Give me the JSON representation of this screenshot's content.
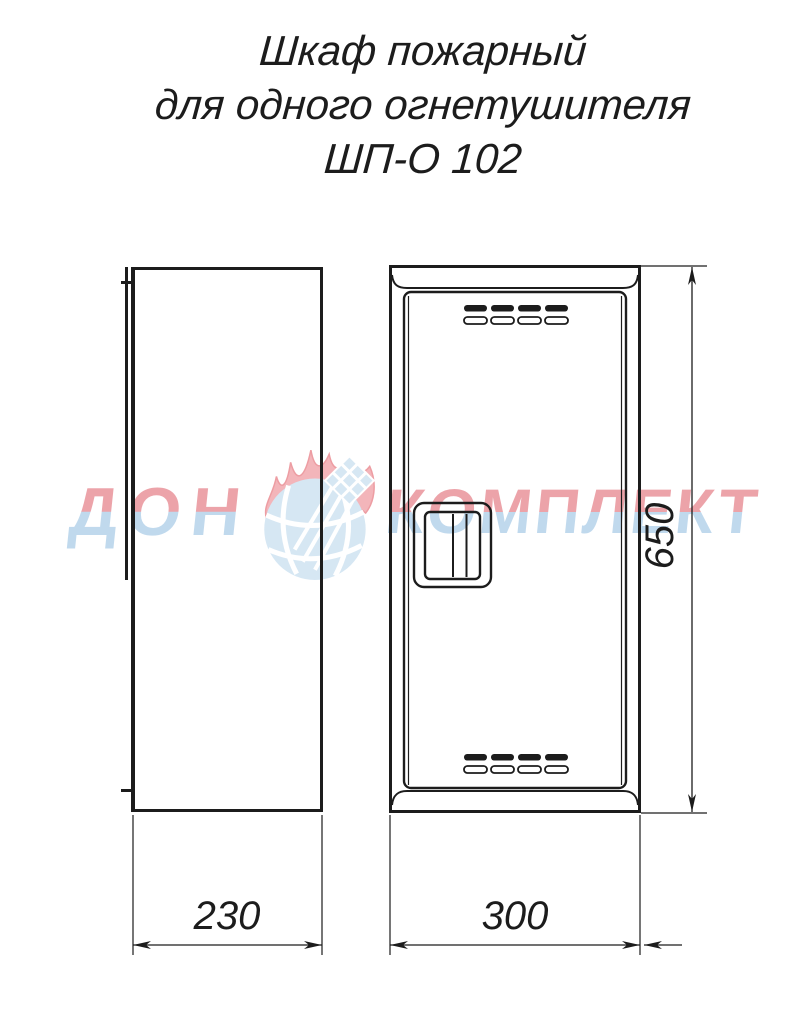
{
  "title": {
    "line1": "Шкаф пожарный",
    "line2": "для одного огнетушителя",
    "line3": "ШП-О 102"
  },
  "watermark": {
    "word_left": "ДОН",
    "word_right": "КОМПЛЕКТ",
    "logo": "fire-globe-logo",
    "color_letter_top": "#e9939b",
    "color_letter_bottom": "#b6d3ea",
    "color_flame": "#f1a9ae",
    "color_flame_accent": "#ea8d93",
    "color_globe": "#cfe3f2"
  },
  "dimensions": {
    "side_width": "230",
    "front_width": "300",
    "height": "650"
  },
  "drawing": {
    "line_color": "#1c1c1c",
    "views": [
      "side-view",
      "front-view"
    ]
  }
}
